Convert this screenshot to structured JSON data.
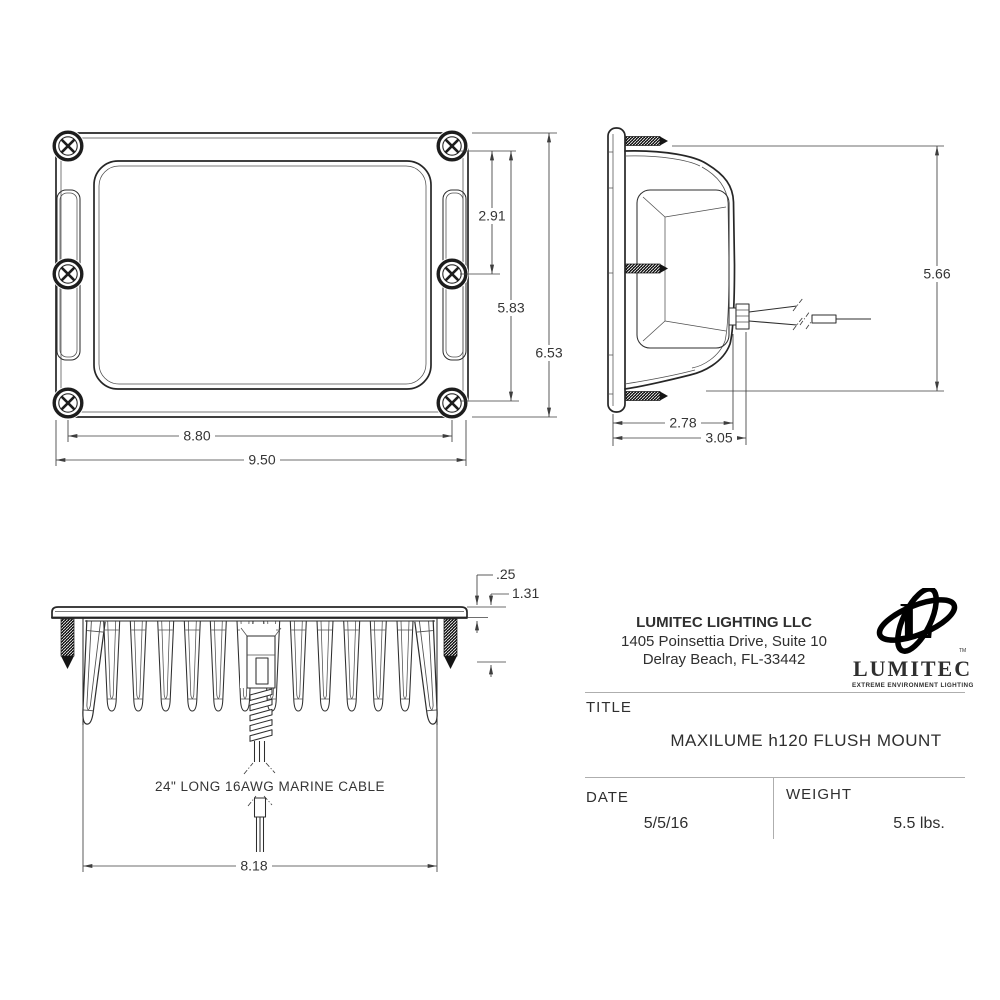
{
  "dims": {
    "front_pitch_half": "2.91",
    "front_pitch": "5.83",
    "front_height": "6.53",
    "front_hole_width": "8.80",
    "front_width": "9.50",
    "side_height": "5.66",
    "side_depth_body": "2.78",
    "side_depth_total": "3.05",
    "flange_thickness": ".25",
    "recess_depth": "1.31",
    "heatsink_width": "8.18"
  },
  "notes": {
    "cable": "24\" LONG 16AWG MARINE CABLE"
  },
  "title_block": {
    "company_name": "LUMITEC LIGHTING LLC",
    "address_line1": "1405 Poinsettia Drive, Suite 10",
    "address_line2": "Delray Beach, FL-33442",
    "logo": {
      "letter": "L",
      "wordmark": "LUMITEC",
      "tagline": "EXTREME ENVIRONMENT LIGHTING",
      "trademark": "TM"
    },
    "title_label": "TITLE",
    "title_value": "MAXILUME h120 FLUSH MOUNT",
    "date_label": "DATE",
    "date_value": "5/5/16",
    "weight_label": "WEIGHT",
    "weight_value": "5.5 lbs."
  },
  "colors": {
    "line": "#262626",
    "dimension": "#3e3e3e",
    "background": "#ffffff",
    "divider": "#aeaeae"
  }
}
